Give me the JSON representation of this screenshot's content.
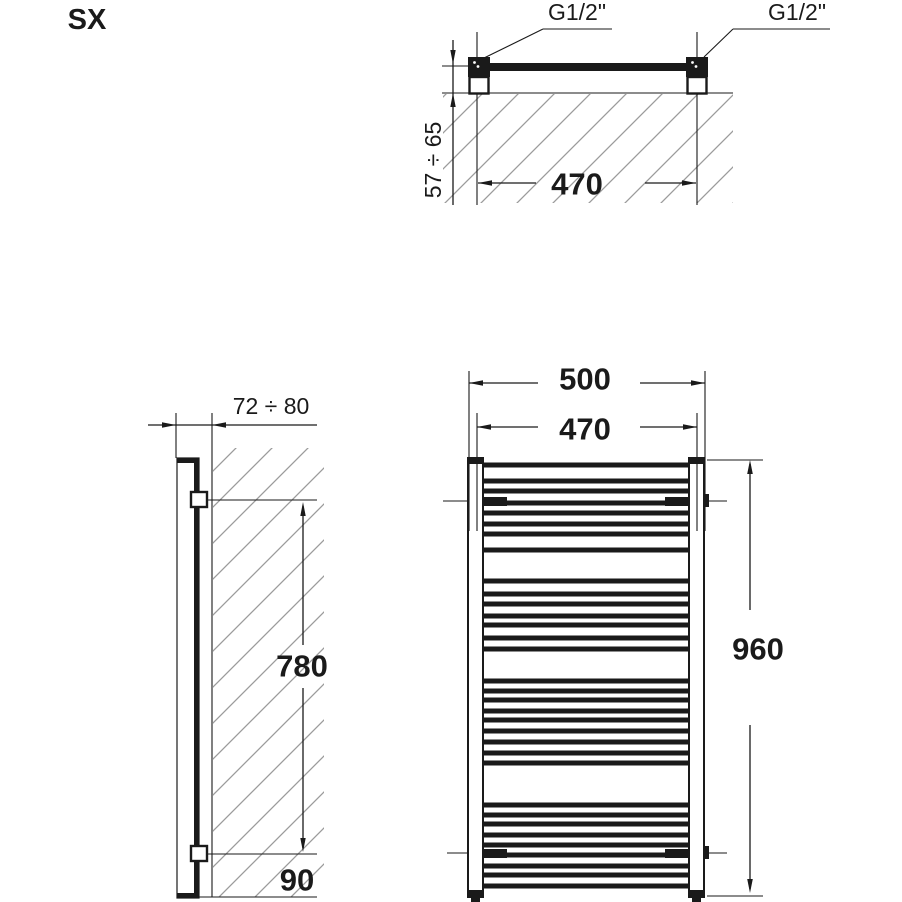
{
  "drawing_label": "SX",
  "colors": {
    "line": "#1a1a1a",
    "hatch": "#9b9b9b",
    "background": "#ffffff"
  },
  "top_view": {
    "connection_label_left": "G1/2\"",
    "connection_label_right": "G1/2\"",
    "pitch_dim": "470",
    "wall_distance_dim": "57 ÷ 65"
  },
  "side_view": {
    "depth_dim": "72 ÷ 80",
    "connection_height_dim": "780",
    "bottom_offset_dim": "90"
  },
  "front_view": {
    "overall_width_dim": "500",
    "pitch_dim": "470",
    "overall_height_dim": "960",
    "rungs_y": [
      465,
      481,
      491,
      503,
      513,
      524,
      534,
      550,
      581,
      594,
      604,
      616,
      625,
      638,
      649,
      681,
      691,
      700,
      711,
      720,
      731,
      742,
      753,
      763,
      805,
      815,
      824,
      835,
      845,
      855,
      866,
      875,
      886
    ]
  }
}
